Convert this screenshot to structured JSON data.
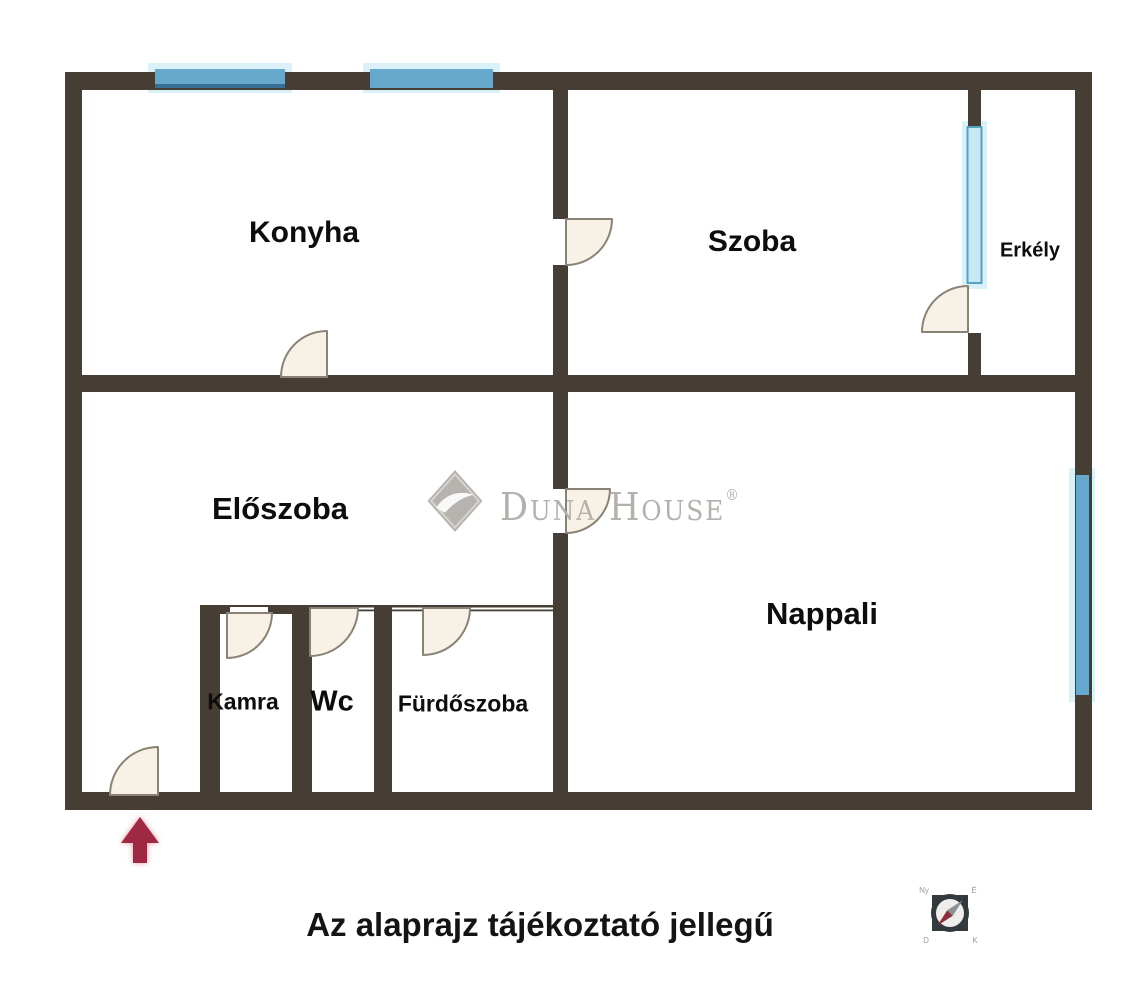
{
  "plan": {
    "rooms": [
      {
        "id": "konyha",
        "label": "Konyha"
      },
      {
        "id": "szoba",
        "label": "Szoba"
      },
      {
        "id": "erkely",
        "label": "Erkély"
      },
      {
        "id": "eloszoba",
        "label": "Előszoba"
      },
      {
        "id": "nappali",
        "label": "Nappali"
      },
      {
        "id": "kamra",
        "label": "Kamra"
      },
      {
        "id": "wc",
        "label": "Wc"
      },
      {
        "id": "furdoszoba",
        "label": "Fürdőszoba"
      }
    ],
    "disclaimer": "Az alaprajz tájékoztató jellegű"
  },
  "watermark": {
    "brand": "Duna House",
    "registered": "®"
  },
  "compass": {
    "marks": {
      "ne": "É",
      "se": "K",
      "sw": "D",
      "nw": "Ny"
    }
  },
  "colors": {
    "wall": "#463e35",
    "window_blue": "#66a9cd",
    "window_dark": "#3a6f94",
    "window_light": "#c8e9f3",
    "window_light_stroke": "#58a0bf",
    "window_glow": "#d5eef7",
    "door_fill": "#f8f1e6",
    "door_stroke": "#8b8276",
    "arrow_red": "#9d2b42",
    "watermark_gray": "#b4b1ac",
    "compass_dark": "#333a3e",
    "compass_face": "#f0eeec",
    "compass_red": "#8e2f3e",
    "compass_needle_gray": "#8c9097"
  }
}
